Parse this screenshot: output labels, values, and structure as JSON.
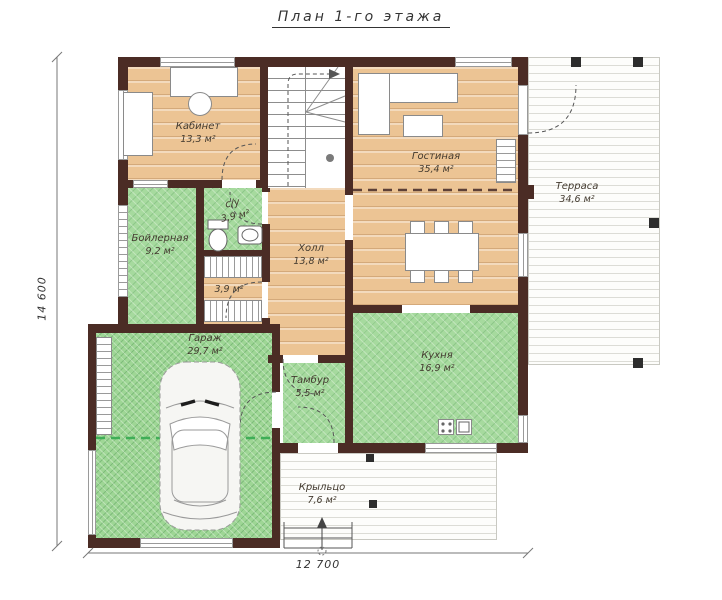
{
  "title": "План 1-го этажа",
  "dimensions": {
    "height_label": "14 600",
    "width_label": "12 700"
  },
  "rooms": {
    "kabinet": {
      "name": "Кабинет",
      "area": "13,3 м²"
    },
    "gostinaya": {
      "name": "Гостиная",
      "area": "35,4 м²"
    },
    "terrasa": {
      "name": "Терраса",
      "area": "34,6 м²"
    },
    "boylernaya": {
      "name": "Бойлерная",
      "area": "9,2 м²"
    },
    "su": {
      "name": "с/у",
      "area": "3,9 м²"
    },
    "laundry": {
      "area": "3,9 м²"
    },
    "holl": {
      "name": "Холл",
      "area": "13,8 м²"
    },
    "kuhnya": {
      "name": "Кухня",
      "area": "16,9 м²"
    },
    "garazh": {
      "name": "Гараж",
      "area": "29,7 м²"
    },
    "tambur": {
      "name": "Тамбур",
      "area": "5,5 м²"
    },
    "krylco": {
      "name": "Крыльцо",
      "area": "7,6 м²"
    }
  },
  "colors": {
    "wall": "#4b2c25",
    "wood": "#ecc494",
    "tile": "#a6da9e",
    "garage": "#9ed695",
    "deck": "#fdfdfb",
    "ink": "#433a2f"
  }
}
